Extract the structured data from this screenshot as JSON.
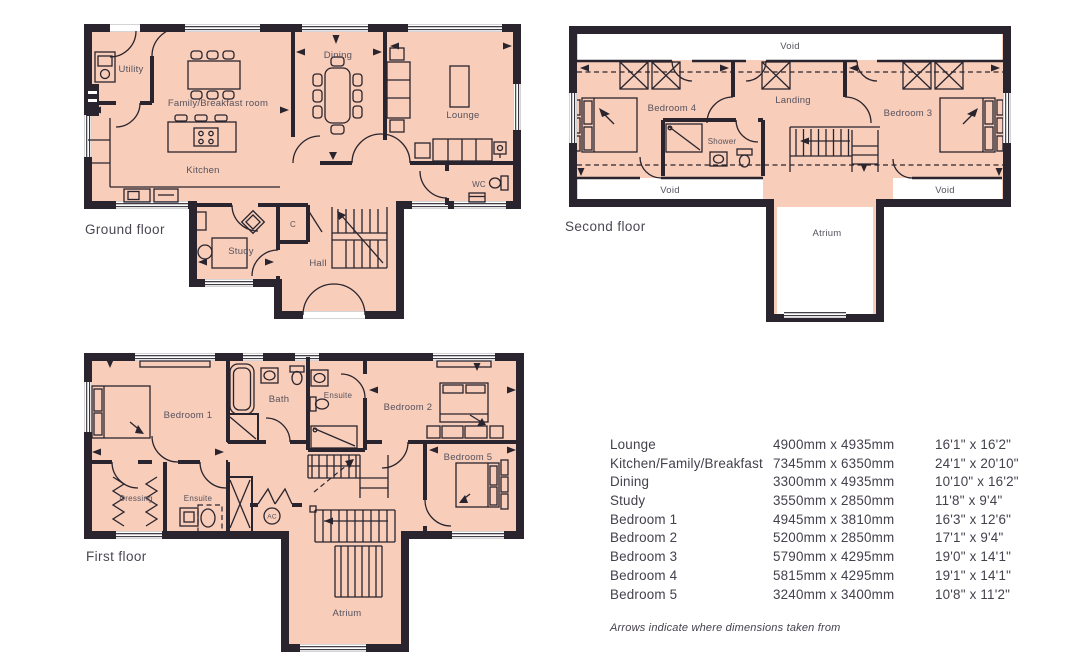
{
  "colors": {
    "background": "#ffffff",
    "room_fill": "#f8cdb9",
    "wall": "#29242e",
    "label_text": "#57525e",
    "table_text": "#44404c"
  },
  "floors": {
    "ground": {
      "label": "Ground floor",
      "rooms": {
        "utility": "Utility",
        "family": "Family/Breakfast room",
        "kitchen": "Kitchen",
        "dining": "Dining",
        "lounge": "Lounge",
        "wc": "WC",
        "study": "Study",
        "hall": "Hall",
        "cupboard": "C"
      }
    },
    "second": {
      "label": "Second floor",
      "rooms": {
        "void_top": "Void",
        "bedroom4": "Bedroom 4",
        "landing": "Landing",
        "bedroom3": "Bedroom 3",
        "shower": "Shower",
        "void_left": "Void",
        "void_right": "Void",
        "atrium": "Atrium"
      }
    },
    "first": {
      "label": "First floor",
      "rooms": {
        "bedroom1": "Bedroom 1",
        "bath": "Bath",
        "ensuite_top": "Ensuite",
        "bedroom2": "Bedroom 2",
        "bedroom5": "Bedroom 5",
        "dressing": "Dressing",
        "ensuite_bottom": "Ensuite",
        "ac": "AC",
        "atrium": "Atrium"
      }
    }
  },
  "dimensions_table": {
    "rows": [
      {
        "room": "Lounge",
        "metric": "4900mm x 4935mm",
        "imperial": "16'1\" x 16'2\""
      },
      {
        "room": "Kitchen/Family/Breakfast",
        "metric": "7345mm x 6350mm",
        "imperial": "24'1\" x 20'10\""
      },
      {
        "room": "Dining",
        "metric": "3300mm x 4935mm",
        "imperial": "10'10\" x 16'2\""
      },
      {
        "room": "Study",
        "metric": "3550mm x 2850mm",
        "imperial": "11'8\" x 9'4\""
      },
      {
        "room": "Bedroom 1",
        "metric": "4945mm x 3810mm",
        "imperial": "16'3\" x 12'6\""
      },
      {
        "room": "Bedroom 2",
        "metric": "5200mm x 2850mm",
        "imperial": "17'1\" x 9'4\""
      },
      {
        "room": "Bedroom 3",
        "metric": "5790mm x 4295mm",
        "imperial": "19'0\" x 14'1\""
      },
      {
        "room": "Bedroom 4",
        "metric": "5815mm x 4295mm",
        "imperial": "19'1\" x 14'1\""
      },
      {
        "room": "Bedroom 5",
        "metric": "3240mm x 3400mm",
        "imperial": "10'8\" x 11'2\""
      }
    ],
    "footnote": "Arrows indicate where dimensions taken from"
  }
}
